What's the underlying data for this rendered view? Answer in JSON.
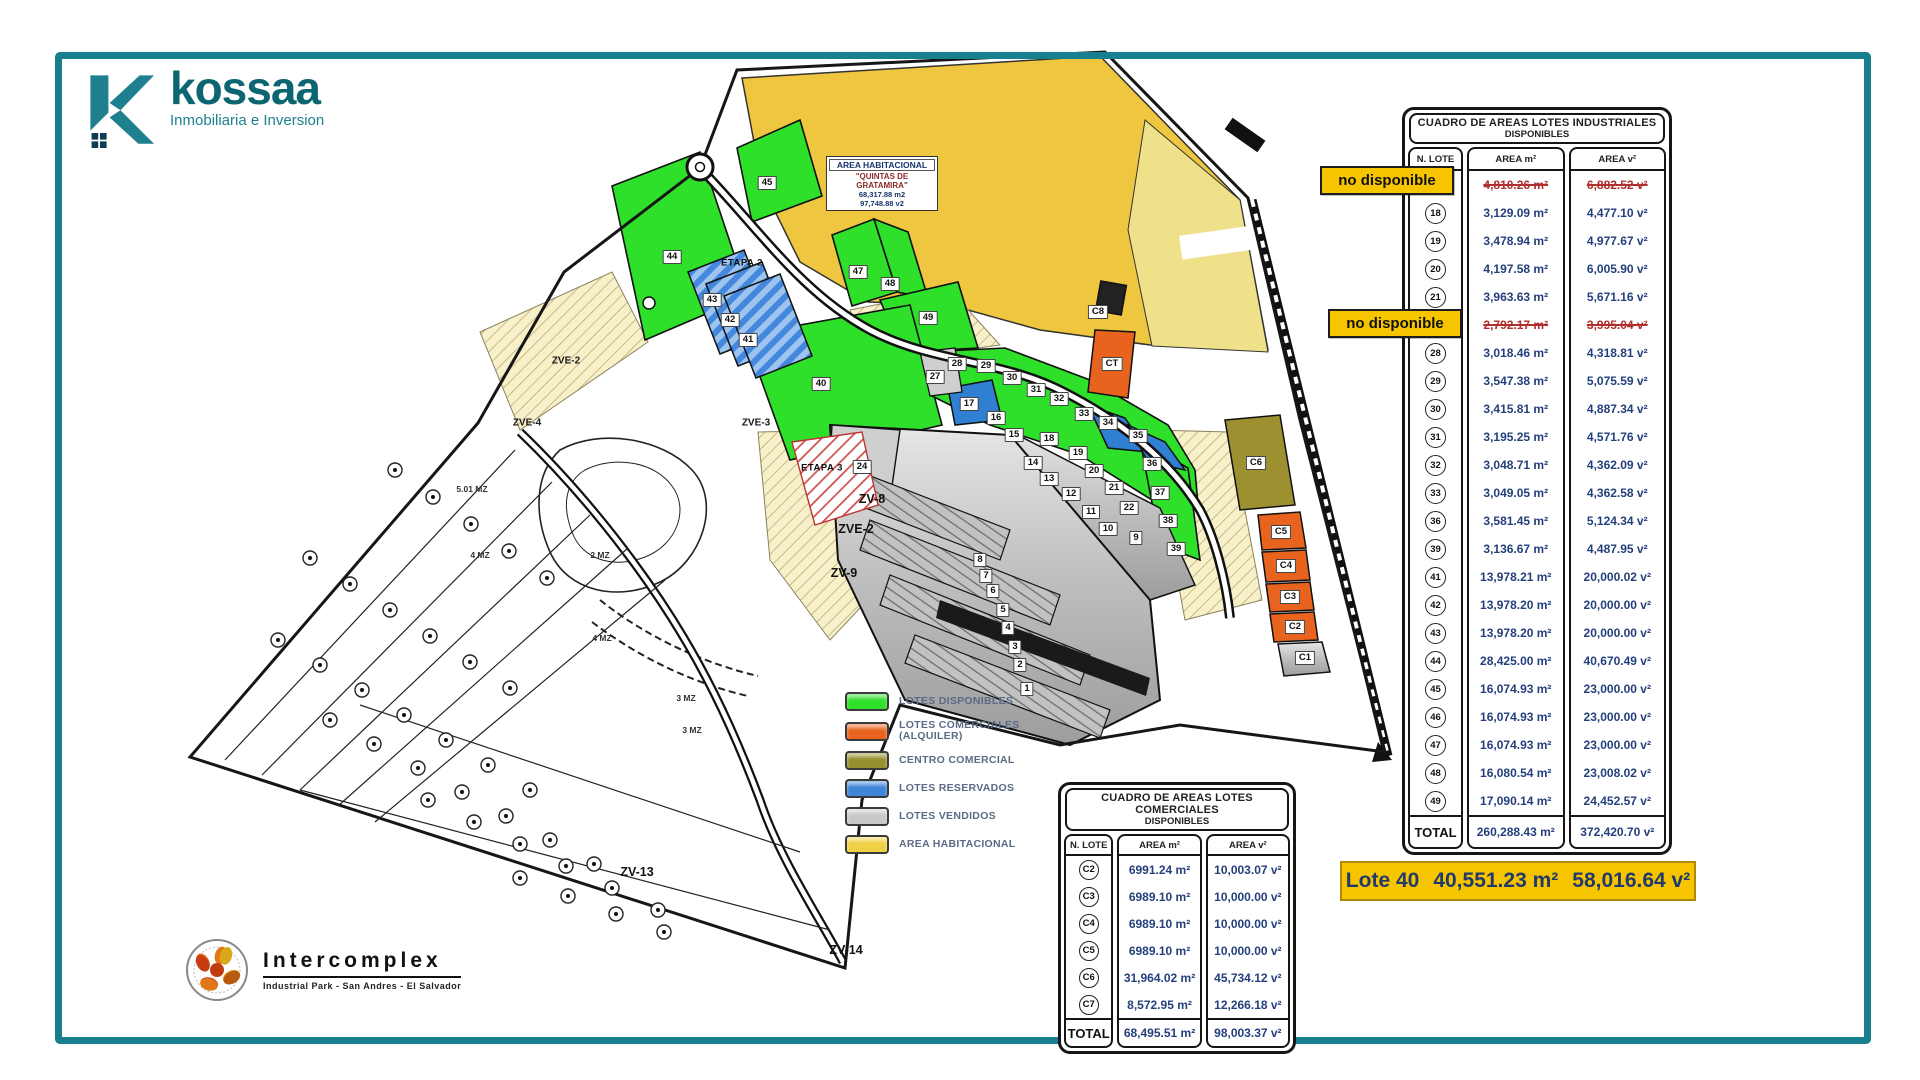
{
  "brand": {
    "name": "kossaa",
    "tagline": "Inmobiliaria e Inversion"
  },
  "industrial_table": {
    "title_line1": "CUADRO DE AREAS LOTES INDUSTRIALES",
    "title_line2": "DISPONIBLES",
    "columns": [
      "N. LOTE",
      "AREA m²",
      "AREA v²"
    ],
    "unavailable_label": "no disponible",
    "rows": [
      {
        "lot": "",
        "area_m": "4,810.26 m²",
        "area_v": "6,882.52 v²",
        "na": true
      },
      {
        "lot": "18",
        "area_m": "3,129.09 m²",
        "area_v": "4,477.10 v²"
      },
      {
        "lot": "19",
        "area_m": "3,478.94 m²",
        "area_v": "4,977.67 v²"
      },
      {
        "lot": "20",
        "area_m": "4,197.58 m²",
        "area_v": "6,005.90 v²"
      },
      {
        "lot": "21",
        "area_m": "3,963.63 m²",
        "area_v": "5,671.16 v²"
      },
      {
        "lot": "",
        "area_m": "2,792.17 m²",
        "area_v": "3,995.04 v²",
        "na": true
      },
      {
        "lot": "28",
        "area_m": "3,018.46 m²",
        "area_v": "4,318.81 v²"
      },
      {
        "lot": "29",
        "area_m": "3,547.38 m²",
        "area_v": "5,075.59 v²"
      },
      {
        "lot": "30",
        "area_m": "3,415.81 m²",
        "area_v": "4,887.34 v²"
      },
      {
        "lot": "31",
        "area_m": "3,195.25 m²",
        "area_v": "4,571.76 v²"
      },
      {
        "lot": "32",
        "area_m": "3,048.71 m²",
        "area_v": "4,362.09 v²"
      },
      {
        "lot": "33",
        "area_m": "3,049.05 m²",
        "area_v": "4,362.58 v²"
      },
      {
        "lot": "36",
        "area_m": "3,581.45 m²",
        "area_v": "5,124.34 v²"
      },
      {
        "lot": "39",
        "area_m": "3,136.67 m²",
        "area_v": "4,487.95 v²"
      },
      {
        "lot": "41",
        "area_m": "13,978.21 m²",
        "area_v": "20,000.02 v²"
      },
      {
        "lot": "42",
        "area_m": "13,978.20 m²",
        "area_v": "20,000.00 v²"
      },
      {
        "lot": "43",
        "area_m": "13,978.20 m²",
        "area_v": "20,000.00 v²"
      },
      {
        "lot": "44",
        "area_m": "28,425.00 m²",
        "area_v": "40,670.49 v²"
      },
      {
        "lot": "45",
        "area_m": "16,074.93 m²",
        "area_v": "23,000.00 v²"
      },
      {
        "lot": "46",
        "area_m": "16,074.93 m²",
        "area_v": "23,000.00 v²"
      },
      {
        "lot": "47",
        "area_m": "16,074.93 m²",
        "area_v": "23,000.00 v²"
      },
      {
        "lot": "48",
        "area_m": "16,080.54 m²",
        "area_v": "23,008.02 v²"
      },
      {
        "lot": "49",
        "area_m": "17,090.14 m²",
        "area_v": "24,452.57 v²"
      }
    ],
    "total_label": "TOTAL",
    "total_m": "260,288.43 m²",
    "total_v": "372,420.70 v²"
  },
  "commercial_table": {
    "title_line1": "CUADRO DE AREAS LOTES COMERCIALES",
    "title_line2": "DISPONIBLES",
    "columns": [
      "N. LOTE",
      "AREA m²",
      "AREA v²"
    ],
    "rows": [
      {
        "lot": "C2",
        "area_m": "6991.24 m²",
        "area_v": "10,003.07 v²"
      },
      {
        "lot": "C3",
        "area_m": "6989.10 m²",
        "area_v": "10,000.00 v²"
      },
      {
        "lot": "C4",
        "area_m": "6989.10 m²",
        "area_v": "10,000.00 v²"
      },
      {
        "lot": "C5",
        "area_m": "6989.10 m²",
        "area_v": "10,000.00 v²"
      },
      {
        "lot": "C6",
        "area_m": "31,964.02 m²",
        "area_v": "45,734.12 v²"
      },
      {
        "lot": "C7",
        "area_m": "8,572.95 m²",
        "area_v": "12,266.18 v²"
      }
    ],
    "total_label": "TOTAL",
    "total_m": "68,495.51 m²",
    "total_v": "98,003.37 v²"
  },
  "highlight": {
    "lote": "Lote 40",
    "area_m": "40,551.23 m²",
    "area_v": "58,016.64 v²"
  },
  "legend": {
    "items": [
      {
        "label": "LOTES DISPONIBLES",
        "label2": "",
        "color": "#2fe02b"
      },
      {
        "label": "LOTES COMERCIALES",
        "label2": "(ALQUILER)",
        "color": "#e8641e"
      },
      {
        "label": "CENTRO COMERCIAL",
        "label2": "",
        "color": "#98902e"
      },
      {
        "label": "LOTES RESERVADOS",
        "label2": "",
        "color": "#3f86d8"
      },
      {
        "label": "LOTES VENDIDOS",
        "label2": "",
        "color": "#c8c8c8"
      },
      {
        "label": "AREA HABITACIONAL",
        "label2": "",
        "color": "#f0d045"
      }
    ]
  },
  "intercomplex": {
    "name": "Intercomplex",
    "tagline": "Industrial Park - San Andres - El Salvador"
  },
  "map": {
    "area_box": {
      "l0": "AREA HABITACIONAL",
      "l1": "\"QUINTAS DE",
      "l2": "GRATAMIRA\"",
      "l3": "68,317.88 m2",
      "l4": "97,748.88 v2"
    },
    "labels": [
      {
        "t": "45",
        "x": 767,
        "y": 183,
        "k": "lot"
      },
      {
        "t": "44",
        "x": 672,
        "y": 257,
        "k": "lot"
      },
      {
        "t": "47",
        "x": 858,
        "y": 272,
        "k": "lot"
      },
      {
        "t": "48",
        "x": 890,
        "y": 284,
        "k": "lot"
      },
      {
        "t": "49",
        "x": 928,
        "y": 318,
        "k": "lot"
      },
      {
        "t": "43",
        "x": 712,
        "y": 300,
        "k": "lot"
      },
      {
        "t": "42",
        "x": 730,
        "y": 320,
        "k": "lot"
      },
      {
        "t": "41",
        "x": 748,
        "y": 340,
        "k": "lot"
      },
      {
        "t": "40",
        "x": 821,
        "y": 384,
        "k": "lot"
      },
      {
        "t": "ETAPA 2",
        "x": 742,
        "y": 263,
        "k": "etapa"
      },
      {
        "t": "ETAPA 3",
        "x": 822,
        "y": 468,
        "k": "etapa"
      },
      {
        "t": "27",
        "x": 935,
        "y": 377,
        "k": "lot"
      },
      {
        "t": "28",
        "x": 957,
        "y": 364,
        "k": "lot"
      },
      {
        "t": "29",
        "x": 986,
        "y": 366,
        "k": "lot"
      },
      {
        "t": "30",
        "x": 1012,
        "y": 378,
        "k": "lot"
      },
      {
        "t": "31",
        "x": 1036,
        "y": 390,
        "k": "lot"
      },
      {
        "t": "32",
        "x": 1059,
        "y": 399,
        "k": "lot"
      },
      {
        "t": "33",
        "x": 1084,
        "y": 414,
        "k": "lot"
      },
      {
        "t": "34",
        "x": 1108,
        "y": 423,
        "k": "lot"
      },
      {
        "t": "35",
        "x": 1138,
        "y": 436,
        "k": "lot"
      },
      {
        "t": "17",
        "x": 969,
        "y": 404,
        "k": "lot"
      },
      {
        "t": "16",
        "x": 996,
        "y": 418,
        "k": "lot"
      },
      {
        "t": "15",
        "x": 1014,
        "y": 435,
        "k": "lot"
      },
      {
        "t": "18",
        "x": 1049,
        "y": 439,
        "k": "lot"
      },
      {
        "t": "19",
        "x": 1078,
        "y": 453,
        "k": "lot"
      },
      {
        "t": "14",
        "x": 1033,
        "y": 463,
        "k": "lot"
      },
      {
        "t": "20",
        "x": 1094,
        "y": 471,
        "k": "lot"
      },
      {
        "t": "13",
        "x": 1049,
        "y": 479,
        "k": "lot"
      },
      {
        "t": "21",
        "x": 1114,
        "y": 488,
        "k": "lot"
      },
      {
        "t": "12",
        "x": 1071,
        "y": 494,
        "k": "lot"
      },
      {
        "t": "22",
        "x": 1129,
        "y": 508,
        "k": "lot"
      },
      {
        "t": "11",
        "x": 1091,
        "y": 512,
        "k": "lot"
      },
      {
        "t": "10",
        "x": 1108,
        "y": 529,
        "k": "lot"
      },
      {
        "t": "9",
        "x": 1136,
        "y": 538,
        "k": "lot"
      },
      {
        "t": "24",
        "x": 862,
        "y": 467,
        "k": "lot"
      },
      {
        "t": "36",
        "x": 1152,
        "y": 464,
        "k": "lot"
      },
      {
        "t": "37",
        "x": 1160,
        "y": 493,
        "k": "lot"
      },
      {
        "t": "38",
        "x": 1168,
        "y": 521,
        "k": "lot"
      },
      {
        "t": "39",
        "x": 1176,
        "y": 549,
        "k": "lot"
      },
      {
        "t": "8",
        "x": 980,
        "y": 560,
        "k": "lot"
      },
      {
        "t": "7",
        "x": 986,
        "y": 576,
        "k": "lot"
      },
      {
        "t": "6",
        "x": 993,
        "y": 591,
        "k": "lot"
      },
      {
        "t": "5",
        "x": 1003,
        "y": 610,
        "k": "lot"
      },
      {
        "t": "4",
        "x": 1008,
        "y": 628,
        "k": "lot"
      },
      {
        "t": "3",
        "x": 1015,
        "y": 647,
        "k": "lot"
      },
      {
        "t": "2",
        "x": 1020,
        "y": 665,
        "k": "lot"
      },
      {
        "t": "1",
        "x": 1027,
        "y": 689,
        "k": "lot"
      },
      {
        "t": "C8",
        "x": 1098,
        "y": 312,
        "k": "lotc"
      },
      {
        "t": "CT",
        "x": 1112,
        "y": 364,
        "k": "lotc"
      },
      {
        "t": "C6",
        "x": 1256,
        "y": 463,
        "k": "lotc"
      },
      {
        "t": "C5",
        "x": 1281,
        "y": 532,
        "k": "lotc"
      },
      {
        "t": "C4",
        "x": 1286,
        "y": 566,
        "k": "lotc"
      },
      {
        "t": "C3",
        "x": 1290,
        "y": 597,
        "k": "lotc"
      },
      {
        "t": "C2",
        "x": 1295,
        "y": 627,
        "k": "lotc"
      },
      {
        "t": "C1",
        "x": 1305,
        "y": 658,
        "k": "lotc"
      },
      {
        "t": "ZVE-2",
        "x": 566,
        "y": 361,
        "k": "zone"
      },
      {
        "t": "ZVE-4",
        "x": 527,
        "y": 423,
        "k": "zone"
      },
      {
        "t": "ZVE-3",
        "x": 756,
        "y": 423,
        "k": "zone"
      },
      {
        "t": "ZV-8",
        "x": 872,
        "y": 499,
        "k": "zoneb"
      },
      {
        "t": "ZVE-2",
        "x": 856,
        "y": 529,
        "k": "zoneb"
      },
      {
        "t": "ZV-9",
        "x": 844,
        "y": 573,
        "k": "zoneb"
      },
      {
        "t": "ZV-13",
        "x": 637,
        "y": 872,
        "k": "zoneb"
      },
      {
        "t": "ZV-14",
        "x": 846,
        "y": 950,
        "k": "zoneb"
      },
      {
        "t": "5.01 MZ",
        "x": 472,
        "y": 489,
        "k": "mz"
      },
      {
        "t": "4 MZ",
        "x": 480,
        "y": 555,
        "k": "mz"
      },
      {
        "t": "2 MZ",
        "x": 600,
        "y": 555,
        "k": "mz"
      },
      {
        "t": "4 MZ",
        "x": 602,
        "y": 638,
        "k": "mz"
      },
      {
        "t": "3 MZ",
        "x": 686,
        "y": 698,
        "k": "mz"
      },
      {
        "t": "3 MZ",
        "x": 692,
        "y": 730,
        "k": "mz"
      }
    ]
  }
}
